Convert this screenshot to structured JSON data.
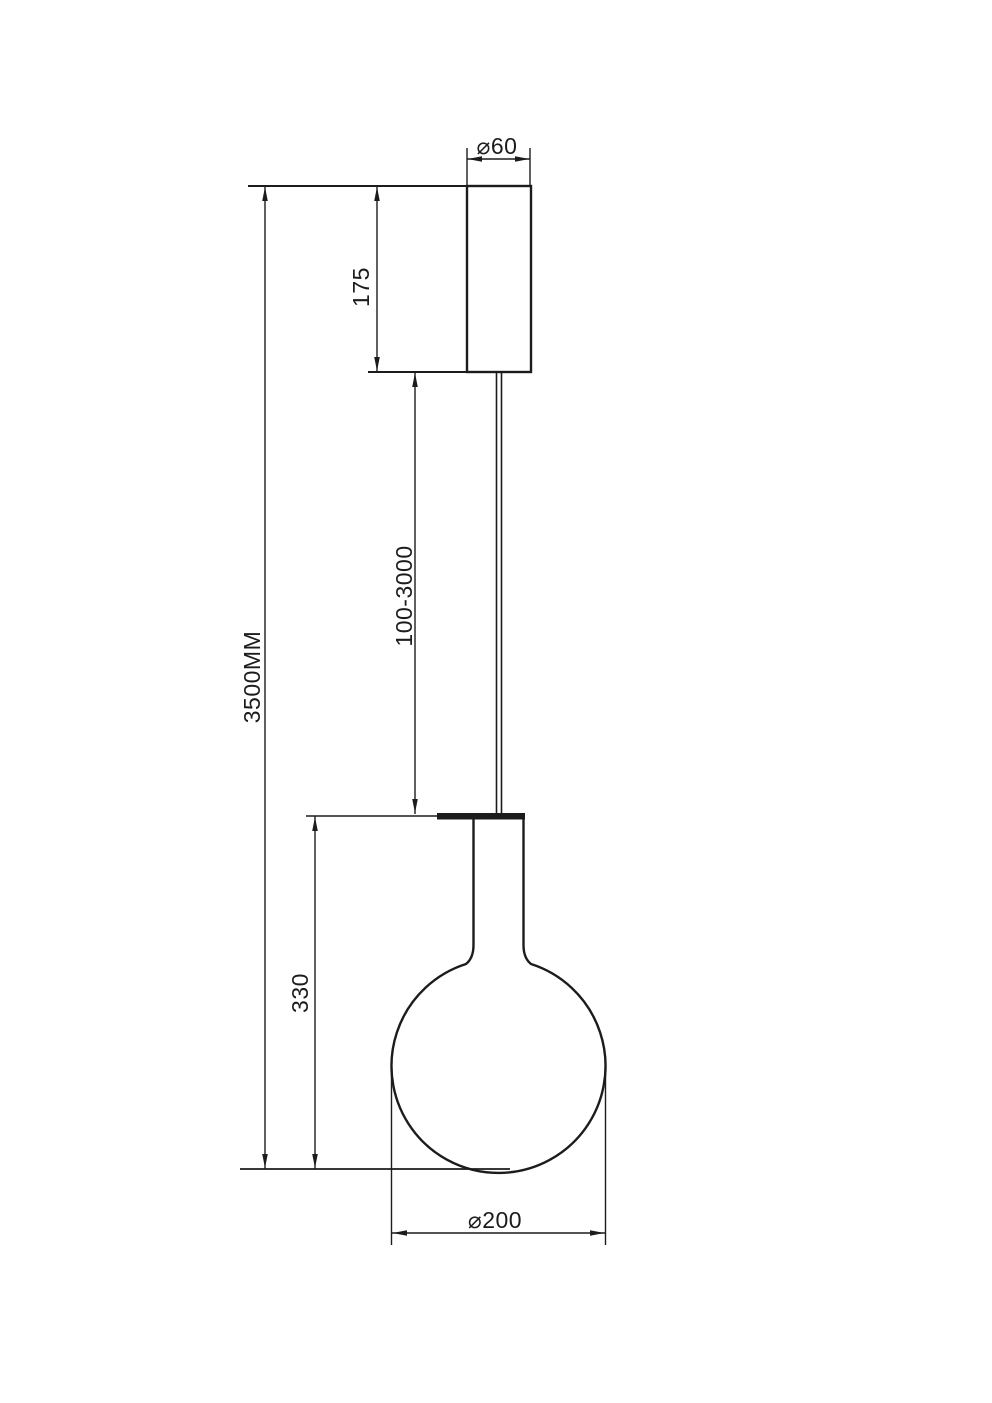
{
  "page": {
    "background_color": "#ffffff",
    "line_color": "#1c1c1c"
  },
  "drawing": {
    "type": "pendant-lamp-dimension-drawing",
    "labels": {
      "canopy_diameter": "⌀60",
      "canopy_height": "175",
      "suspension_length": "100-3000",
      "overall_height": "3500MM",
      "fixture_height": "330",
      "shade_diameter": "⌀200"
    }
  }
}
